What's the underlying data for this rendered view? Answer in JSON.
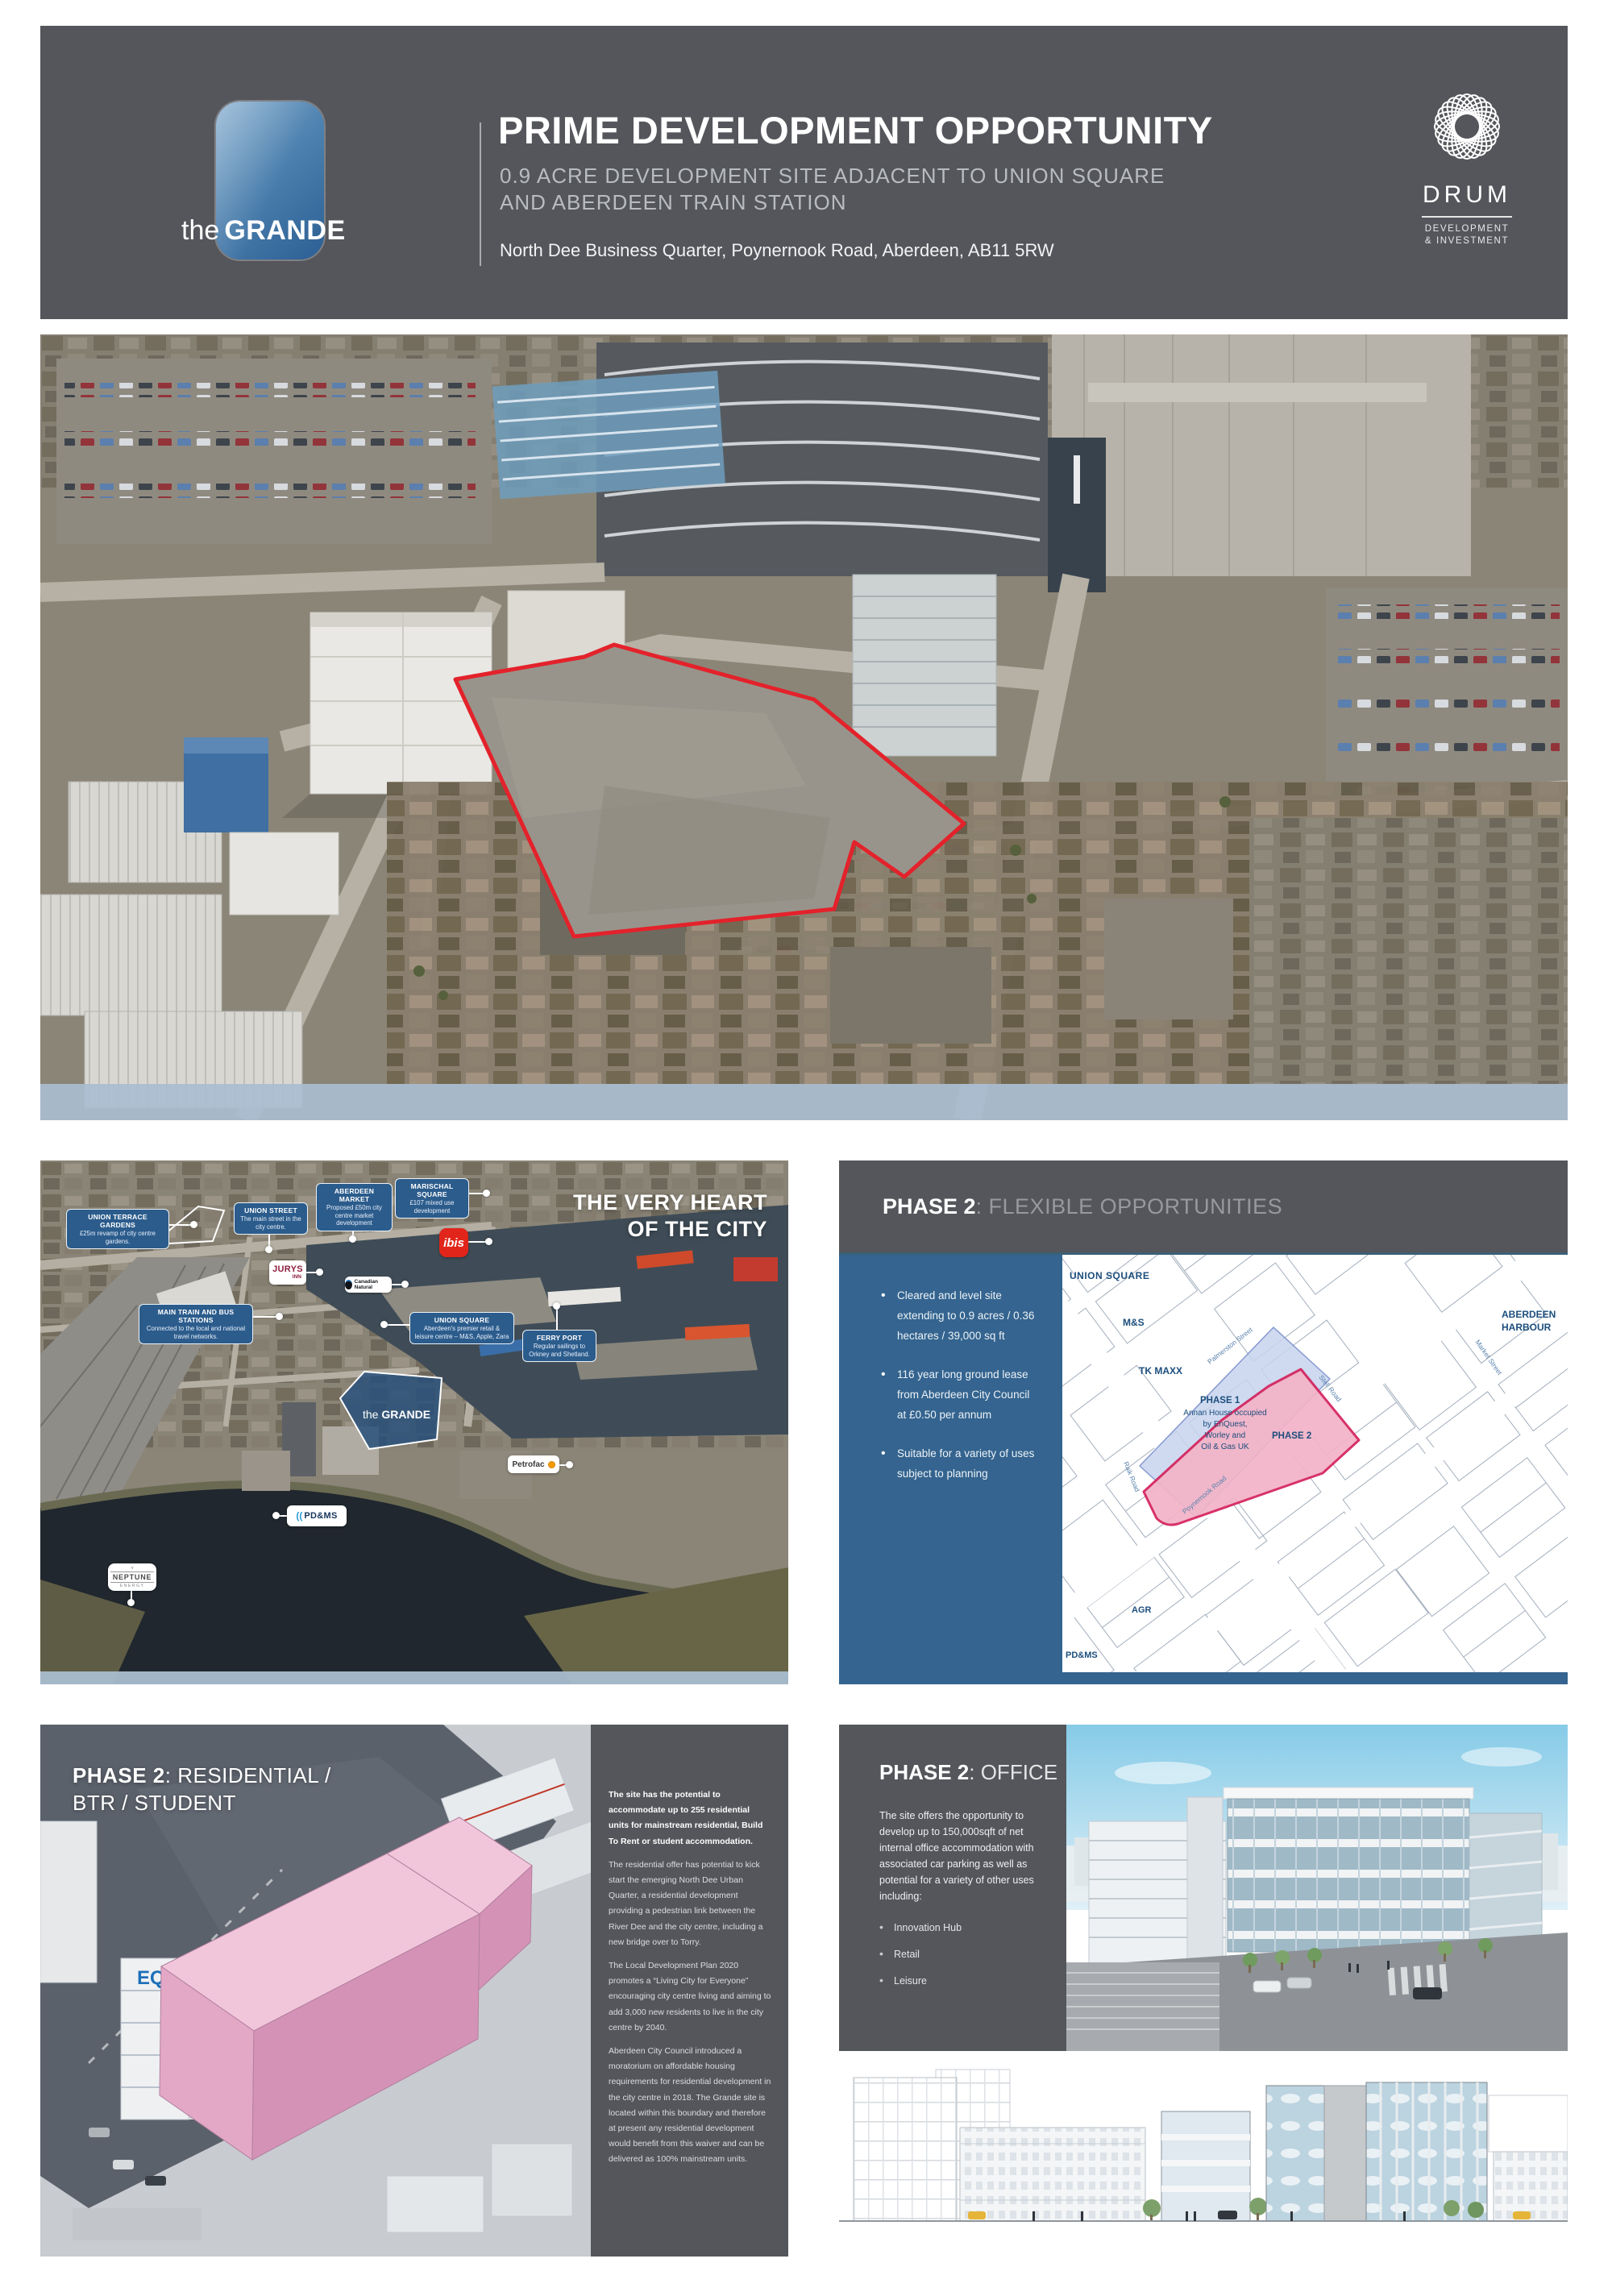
{
  "header": {
    "logo": {
      "prefix": "the",
      "name": "GRANDE"
    },
    "title": "PRIME DEVELOPMENT OPPORTUNITY",
    "subtitle_line1": "0.9 ACRE DEVELOPMENT SITE ADJACENT TO UNION SQUARE",
    "subtitle_line2": "AND ABERDEEN TRAIN STATION",
    "address": "North Dee Business Quarter, Poynernook Road, Aberdeen, AB11 5RW",
    "drum": {
      "name": "DRUM",
      "tagline_line1": "DEVELOPMENT",
      "tagline_line2": "& INVESTMENT"
    }
  },
  "city_map": {
    "title_line1": "THE VERY HEART",
    "title_line2": "OF THE CITY",
    "labels": [
      {
        "title": "UNION TERRACE GARDENS",
        "desc": "£25m revamp of city centre gardens."
      },
      {
        "title": "UNION STREET",
        "desc": "The main street in the city centre."
      },
      {
        "title": "ABERDEEN MARKET",
        "desc": "Proposed £50m city centre market development"
      },
      {
        "title": "MARISCHAL SQUARE",
        "desc": "£107 mixed use development"
      },
      {
        "title": "MAIN TRAIN AND BUS STATIONS",
        "desc": "Connected to the local and national travel networks."
      },
      {
        "title": "UNION SQUARE",
        "desc": "Aberdeen's premier retail & leisure centre – M&S, Apple, Zara"
      },
      {
        "title": "FERRY PORT",
        "desc": "Regular sailings to Orkney and Shetland."
      }
    ],
    "logos": {
      "jurys_line1": "JURYS",
      "jurys_line2": "INN",
      "ibis": "ibis",
      "canadian_natural": "Canadian Natural",
      "petrofac": "Petrofac",
      "pdms": "PD&MS",
      "neptune_line1": "NEPTUNE",
      "neptune_line2": "ENERGY"
    },
    "site_label": {
      "prefix": "the",
      "name": "GRANDE"
    }
  },
  "phase2_flexible": {
    "heading_strong": "PHASE 2",
    "heading_rest": ": FLEXIBLE OPPORTUNITIES",
    "bullets": [
      "Cleared and level site extending to 0.9 acres / 0.36 hectares / 39,000 sq ft",
      "116 year long ground lease from Aberdeen City Council at £0.50 per annum",
      "Suitable for a variety of uses subject to planning"
    ],
    "map": {
      "places": [
        "UNION SQUARE",
        "M&S",
        "TK MAXX",
        "AGR",
        "PD&MS"
      ],
      "harbour_line1": "ABERDEEN",
      "harbour_line2": "HARBOUR",
      "streets": [
        "Palmerston Street",
        "Stell Road",
        "Market Street",
        "Raik Road",
        "Poynernook Road"
      ],
      "phase1_label": "PHASE 1",
      "phase1_desc_line1": "Annan House occupied",
      "phase1_desc_line2": "by EnQuest,",
      "phase1_desc_line3": "Worley and",
      "phase1_desc_line4": "Oil & Gas UK",
      "phase2_label": "PHASE 2"
    }
  },
  "phase2_residential": {
    "heading_strong": "PHASE 2",
    "heading_rest": ": RESIDENTIAL /",
    "heading_line2": "BTR / STUDENT",
    "eq_logo": "EQ",
    "para_bold": "The site has the potential to accommodate up to 255 residential units for mainstream residential, Build To Rent or student accommodation.",
    "paras": [
      "The residential offer has potential to kick start the emerging North Dee Urban Quarter, a residential development providing a pedestrian link between the River Dee and the city centre, including a new bridge over to Torry.",
      "The Local Development Plan 2020 promotes a “Living City for Everyone” encouraging city centre living and aiming to add 3,000 new residents to live in the city centre by 2040.",
      "Aberdeen City Council introduced a moratorium on affordable housing requirements for residential development in the city centre in 2018. The Grande site is located within this boundary and therefore at present any residential development would benefit from this waiver and can be delivered as 100% mainstream units."
    ]
  },
  "phase2_office": {
    "heading_strong": "PHASE 2",
    "heading_rest": ": OFFICE",
    "intro": "The site offers the opportunity to develop up to 150,000sqft of net internal office accommodation with associated car parking as well as potential for a variety of other uses including:",
    "bullets": [
      "Innovation Hub",
      "Retail",
      "Leisure"
    ]
  },
  "colors": {
    "header_gray": "#54565b",
    "steel_blue": "#34648f",
    "label_blue": "#2b5c8c",
    "site_outline_red": "#e3222b",
    "phase1_fill": "#c7d4ee",
    "phase2_fill": "#f3b3c7",
    "phase2_outline": "#d4215c",
    "footer_band_blue": "#a9bdd0",
    "grande_blue": "#3c6ea4",
    "pink_building": "#f2c6da",
    "ibis_red": "#e1251b"
  }
}
